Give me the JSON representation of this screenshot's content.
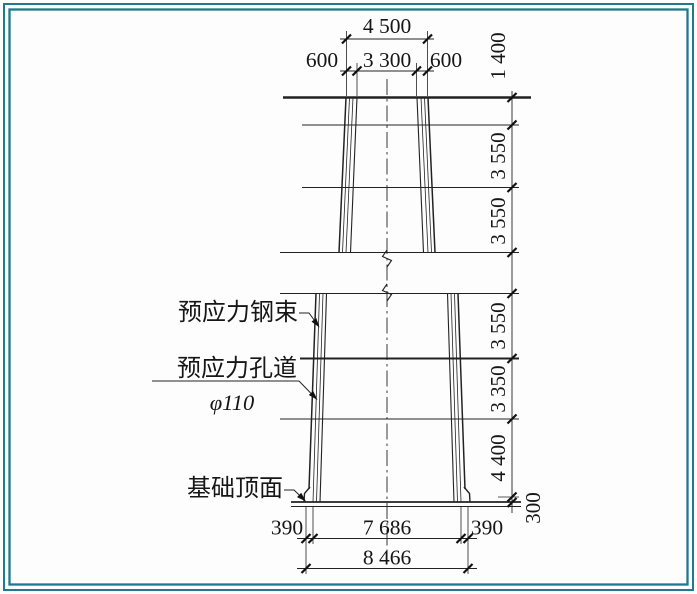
{
  "drawing": {
    "top_dims": {
      "total": "4 500",
      "left_overhang": "600",
      "inner_width": "3 300",
      "right_overhang": "600"
    },
    "right_dims": {
      "seg1": "1 400",
      "seg2": "3 550",
      "seg3": "3 550",
      "seg4": "3 550",
      "seg5": "3 350",
      "seg6": "4 400",
      "seg7": "300"
    },
    "bottom_dims": {
      "left_offset": "390",
      "inner_width": "7 686",
      "right_offset": "390",
      "total": "8 466"
    },
    "labels": {
      "tendon": "预应力钢束",
      "duct": "预应力孔道",
      "duct_diameter": "φ110",
      "foundation_top": "基础顶面"
    },
    "colors": {
      "frame": "#1e7a8c",
      "line": "#222222",
      "background": "#fdfdfd"
    }
  }
}
